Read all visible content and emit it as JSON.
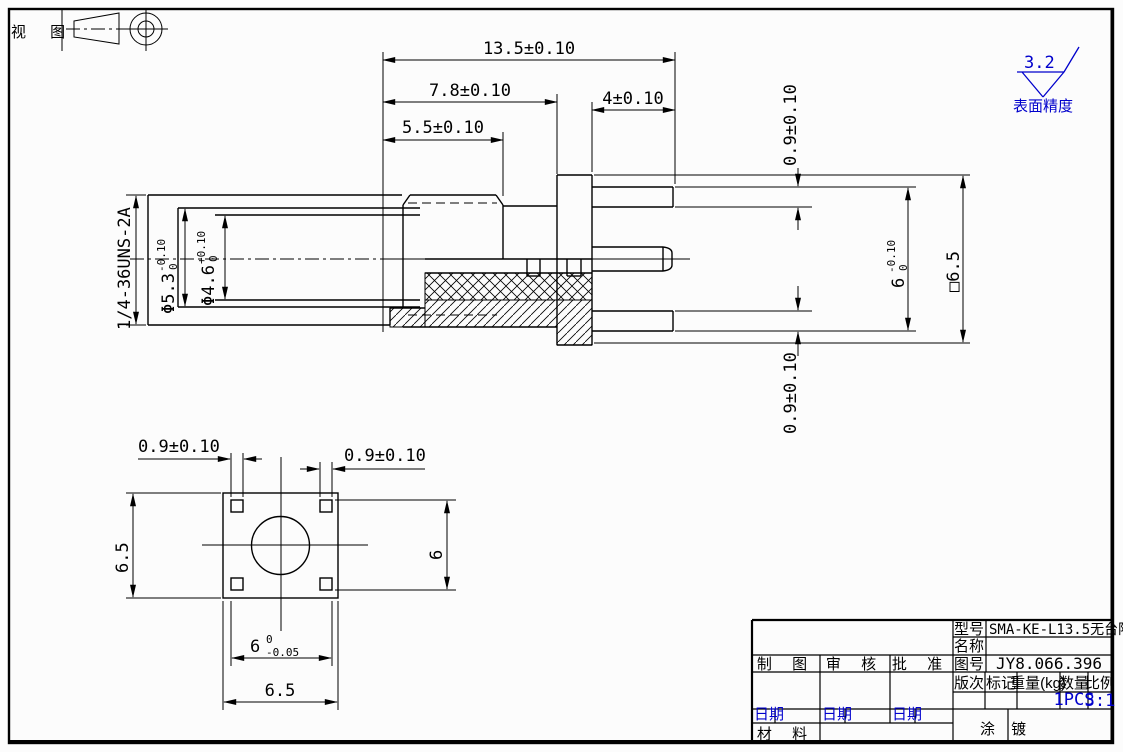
{
  "colors": {
    "line": "#000000",
    "accent": "#0000cc",
    "paper": "#fcfcfc"
  },
  "corner": {
    "view_label": "视 图"
  },
  "surface_finish": {
    "value": "3.2",
    "caption": "表面精度"
  },
  "main_view": {
    "thread_spec": "1/4-36UNS-2A",
    "dia_5_3": {
      "value": "Φ5.3",
      "tol_upper": "-0.10",
      "tol_lower": "0"
    },
    "dia_4_6": {
      "value": "Φ4.6",
      "tol_upper": "+0.10",
      "tol_lower": "0"
    },
    "len_total": "13.5±0.10",
    "len_body": "7.8±0.10",
    "len_nut": "5.5±0.10",
    "len_legs": "4±0.10",
    "leg_top": "0.9±0.10",
    "leg_bottom": "0.9±0.10",
    "height_6": {
      "value": "6",
      "tol_upper": "-0.10",
      "tol_lower": "0"
    },
    "square_6_5": "□6.5"
  },
  "front_view": {
    "leg_left": "0.9±0.10",
    "leg_right": "0.9±0.10",
    "height_left": "6.5",
    "height_right": "6",
    "width_inner": {
      "value": "6",
      "tol_upper": "0",
      "tol_lower": "-0.05"
    },
    "width_outer": "6.5"
  },
  "title_block": {
    "model_label": "型号",
    "model_value": "SMA-KE-L13.5无台阶",
    "name_label": "名称",
    "name_value": "",
    "drawing_label": "制 图",
    "review_label": "审 核",
    "approve_label": "批 准",
    "dwgno_label": "图号",
    "dwgno_value": "JY8.066.396",
    "rev_label": "版次",
    "mark_label": "标记",
    "weight_label": "重量(kg)",
    "qty_label": "数量",
    "scale_label": "比例",
    "qty_value": "1PCS",
    "scale_value": "3:1",
    "date_label": "日期",
    "material_label": "材 料",
    "coating_label": "涂 镀"
  }
}
